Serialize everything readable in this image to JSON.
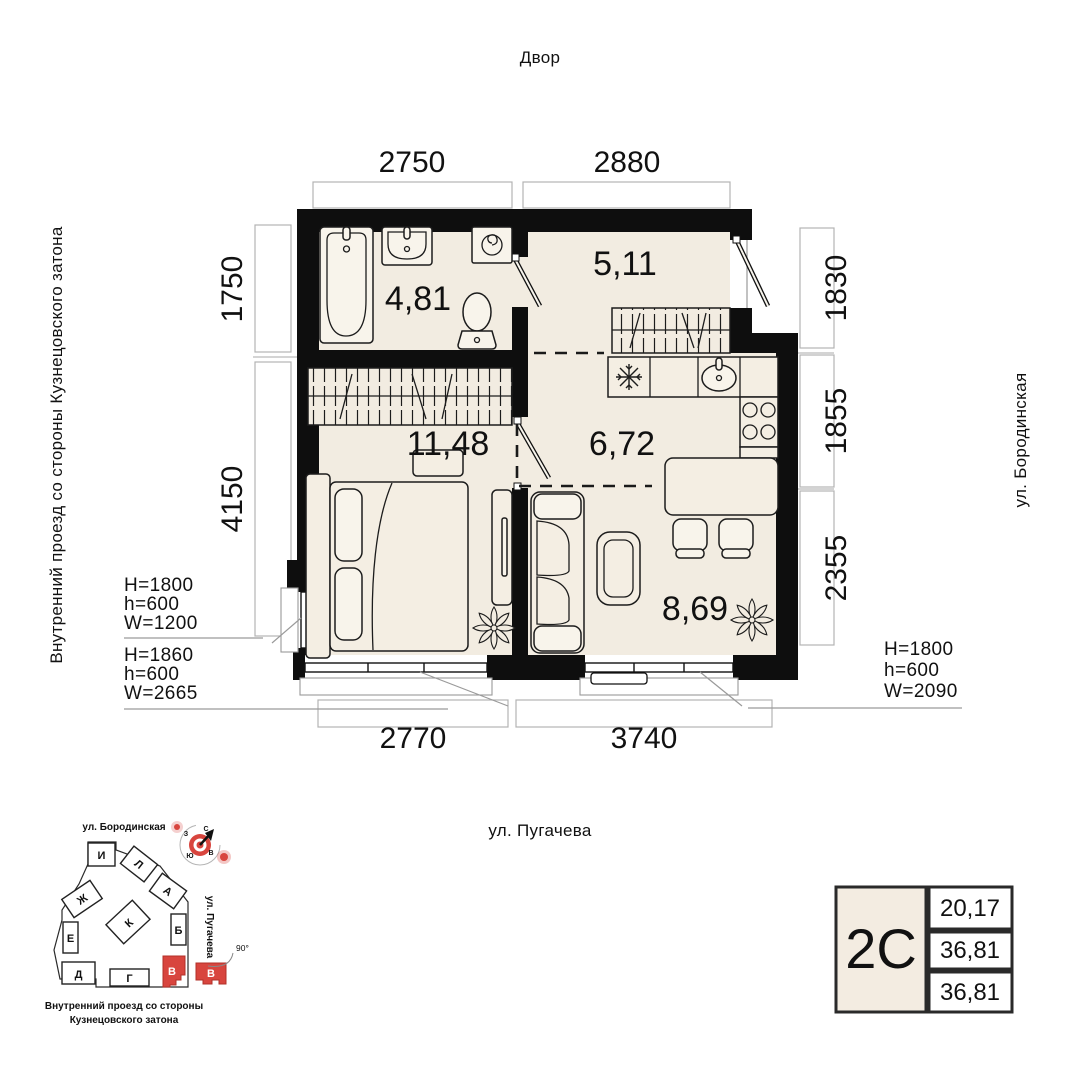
{
  "labels": {
    "top": "Двор",
    "street_left": "Внутренний проезд со стороны Кузнецовского затона",
    "street_right": "ул. Бородинская",
    "street_bottom": "ул. Пугачева"
  },
  "rooms": {
    "bathroom": "4,81",
    "hall": "5,11",
    "bedroom": "11,48",
    "kitchen": "6,72",
    "living": "8,69"
  },
  "dims": {
    "top": [
      "2750",
      "2880"
    ],
    "bottom": [
      "2770",
      "3740"
    ],
    "left": [
      "1750",
      "4150"
    ],
    "right": [
      "1830",
      "1855",
      "2355"
    ]
  },
  "window_specs": [
    {
      "lines": [
        "H=1800",
        "h=600",
        "W=1200"
      ]
    },
    {
      "lines": [
        "H=1860",
        "h=600",
        "W=2665"
      ]
    },
    {
      "lines": [
        "H=1800",
        "h=600",
        "W=2090"
      ]
    }
  ],
  "site_plan": {
    "street_top": "ул. Бородинская",
    "street_side": "ул. Пугачева",
    "caption_1": "Внутренний проезд со стороны",
    "caption_2": "Кузнецовского затона",
    "buildings": [
      "И",
      "Л",
      "А",
      "Ж",
      "К",
      "Б",
      "Е",
      "Д",
      "Г",
      "В",
      "В"
    ],
    "angle": "90°",
    "compass": {
      "n": "С",
      "e": "В",
      "s": "Ю",
      "w": "З"
    }
  },
  "card": {
    "type": "2С",
    "values": [
      "20,17",
      "36,81",
      "36,81"
    ]
  },
  "colors": {
    "floor": "#f2ece1",
    "wall": "#0e0e0e",
    "accent_red": "#d8453e"
  }
}
